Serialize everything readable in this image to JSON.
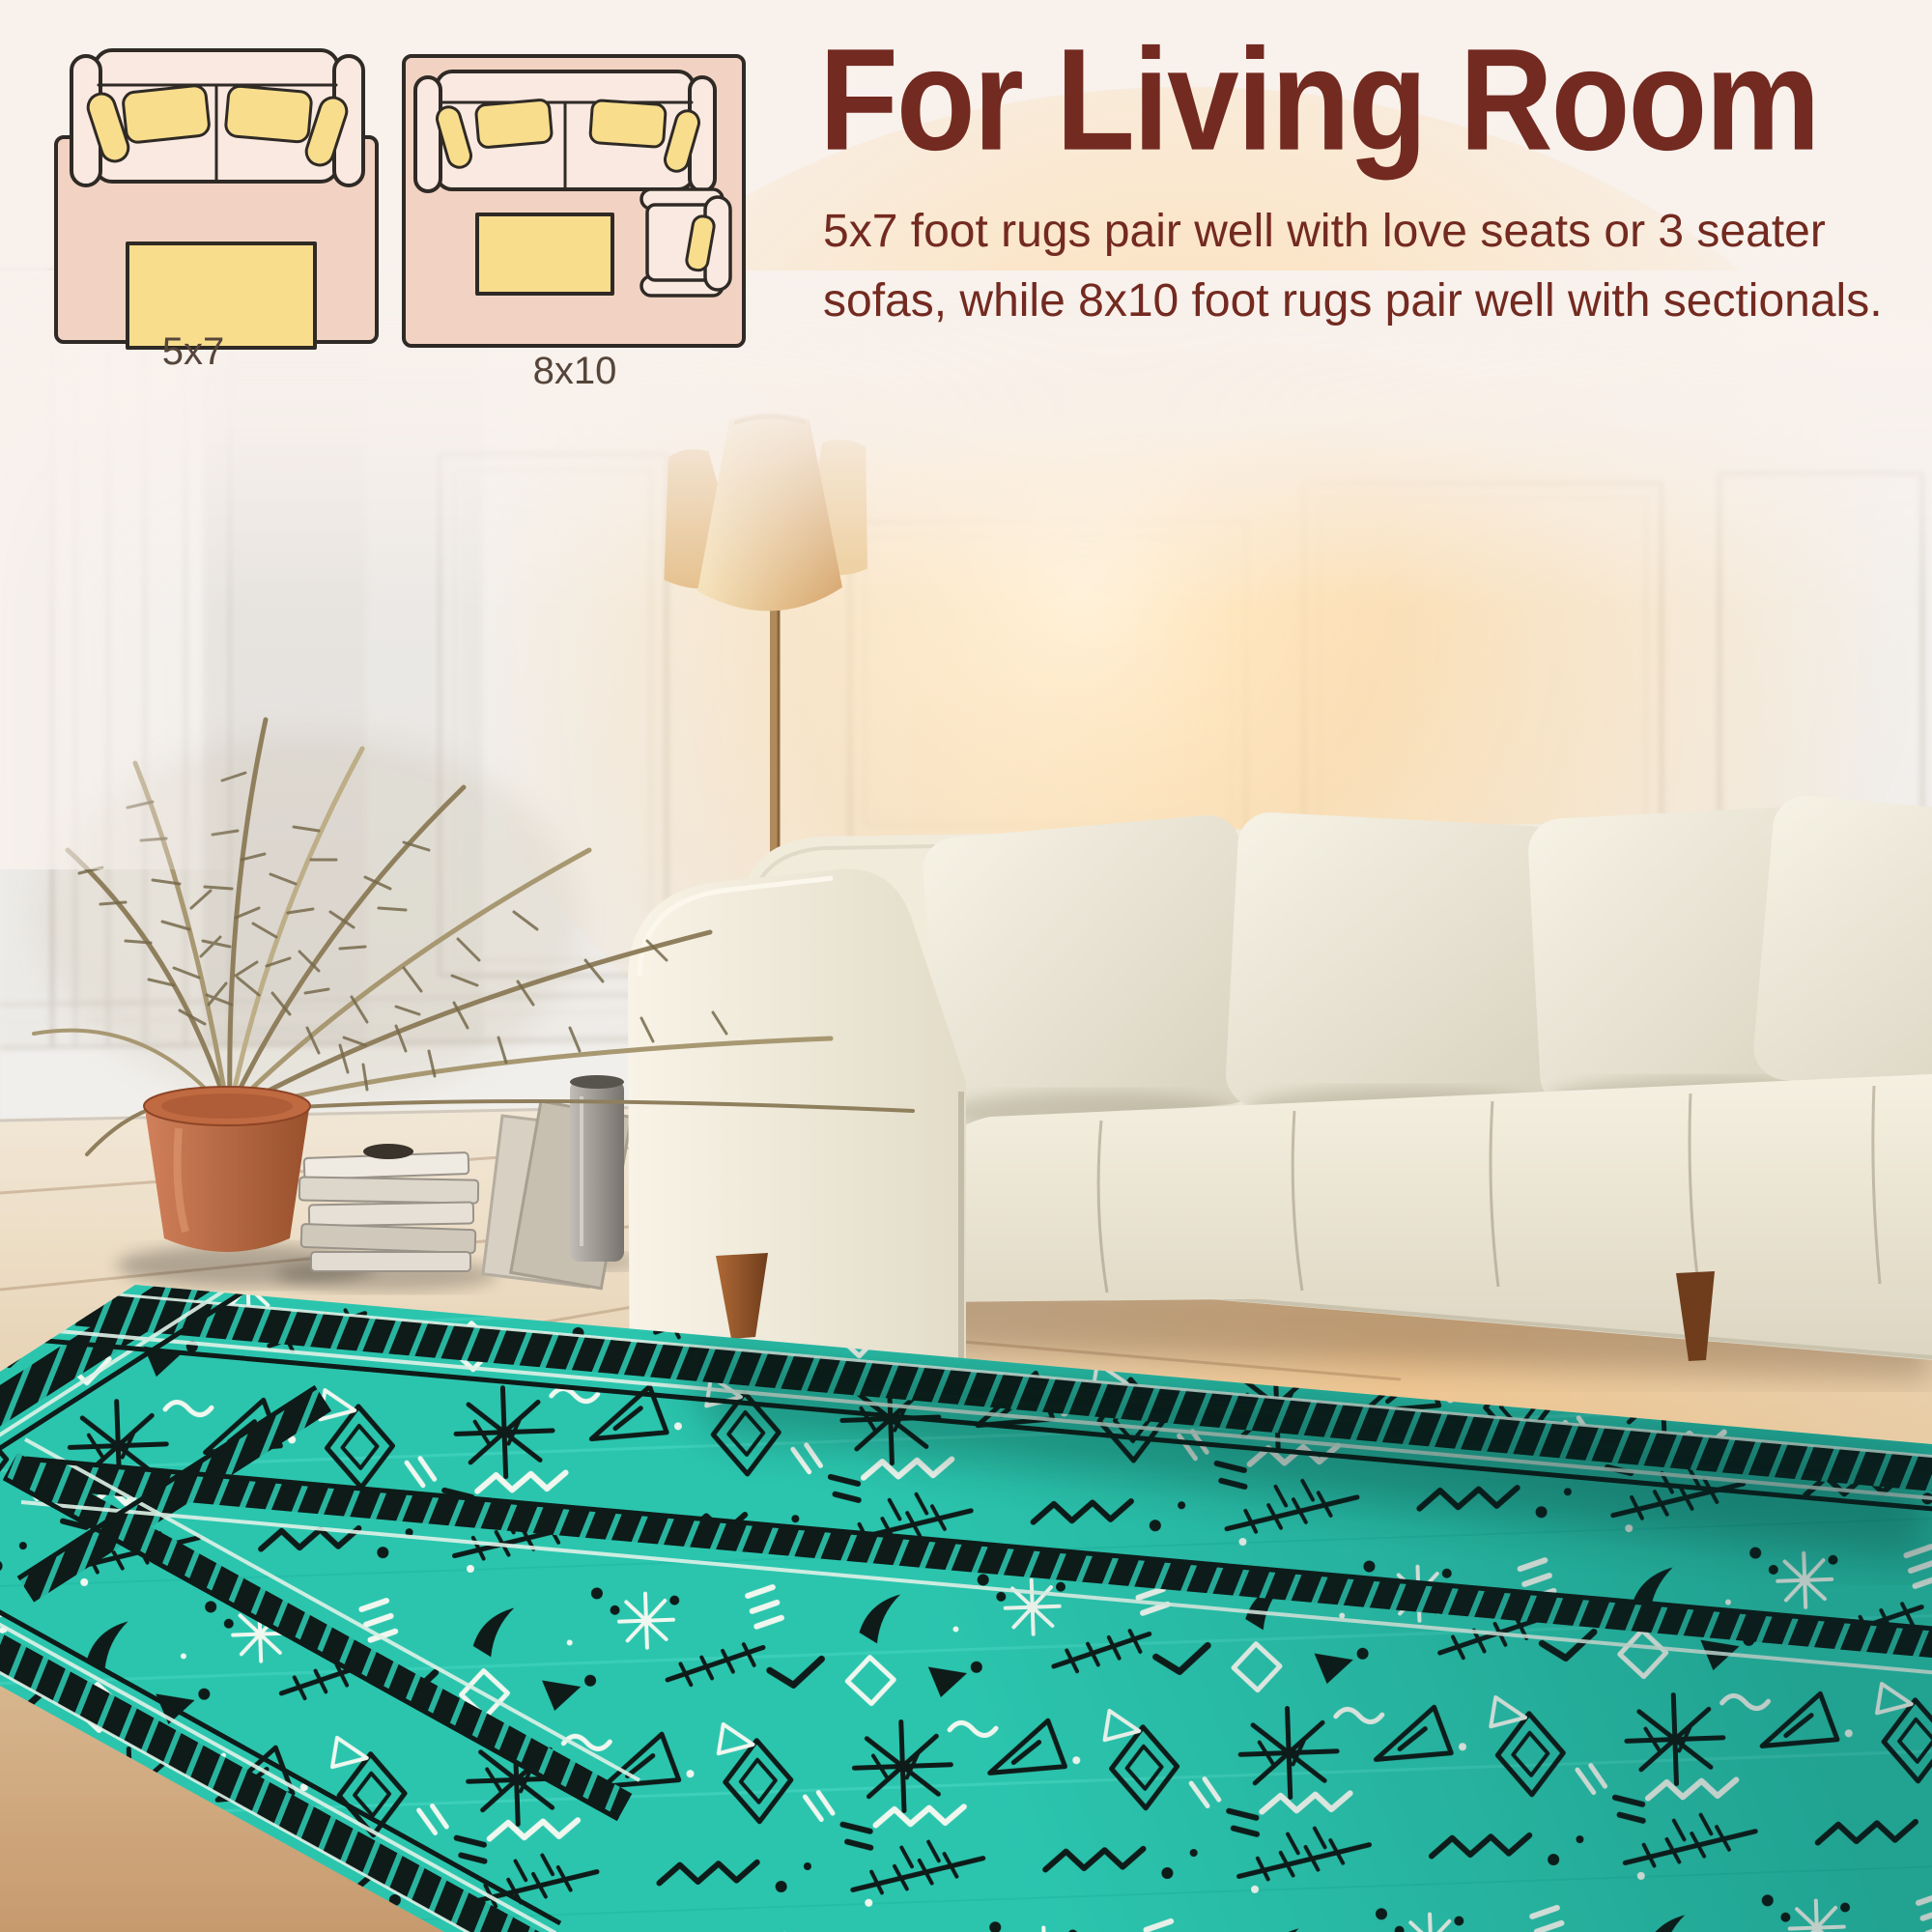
{
  "page": {
    "background_color": "#f8f1ec"
  },
  "header": {
    "title": "For Living Room",
    "text_color": "#732a20",
    "description_line1": "5x7 foot rugs pair well with love seats or 3 seater",
    "description_line2": "sofas, while 8x10 foot rugs pair well with sectionals."
  },
  "size_guide": {
    "small_rug_label": "5x7",
    "large_rug_label": "8x10",
    "label_color": "#55453a",
    "rug_color": "#f2d3c3",
    "sofa_color": "#fae9e1",
    "cushion_color": "#f8dd8d",
    "outline_color": "#2f2a25"
  },
  "scene": {
    "rug_teal": "#2bc5ae",
    "rug_pattern_black": "#0e1b18",
    "rug_pattern_white": "#eff7ef",
    "sofa_ivory": "#f2ecdd",
    "wall_white": "#f5f3f1",
    "floor_wood": "#e6cfa9",
    "pot_terracotta": "#b5653f",
    "lamp_shade_beige": "#e9c98f",
    "sun_glow": "#ffd596"
  }
}
